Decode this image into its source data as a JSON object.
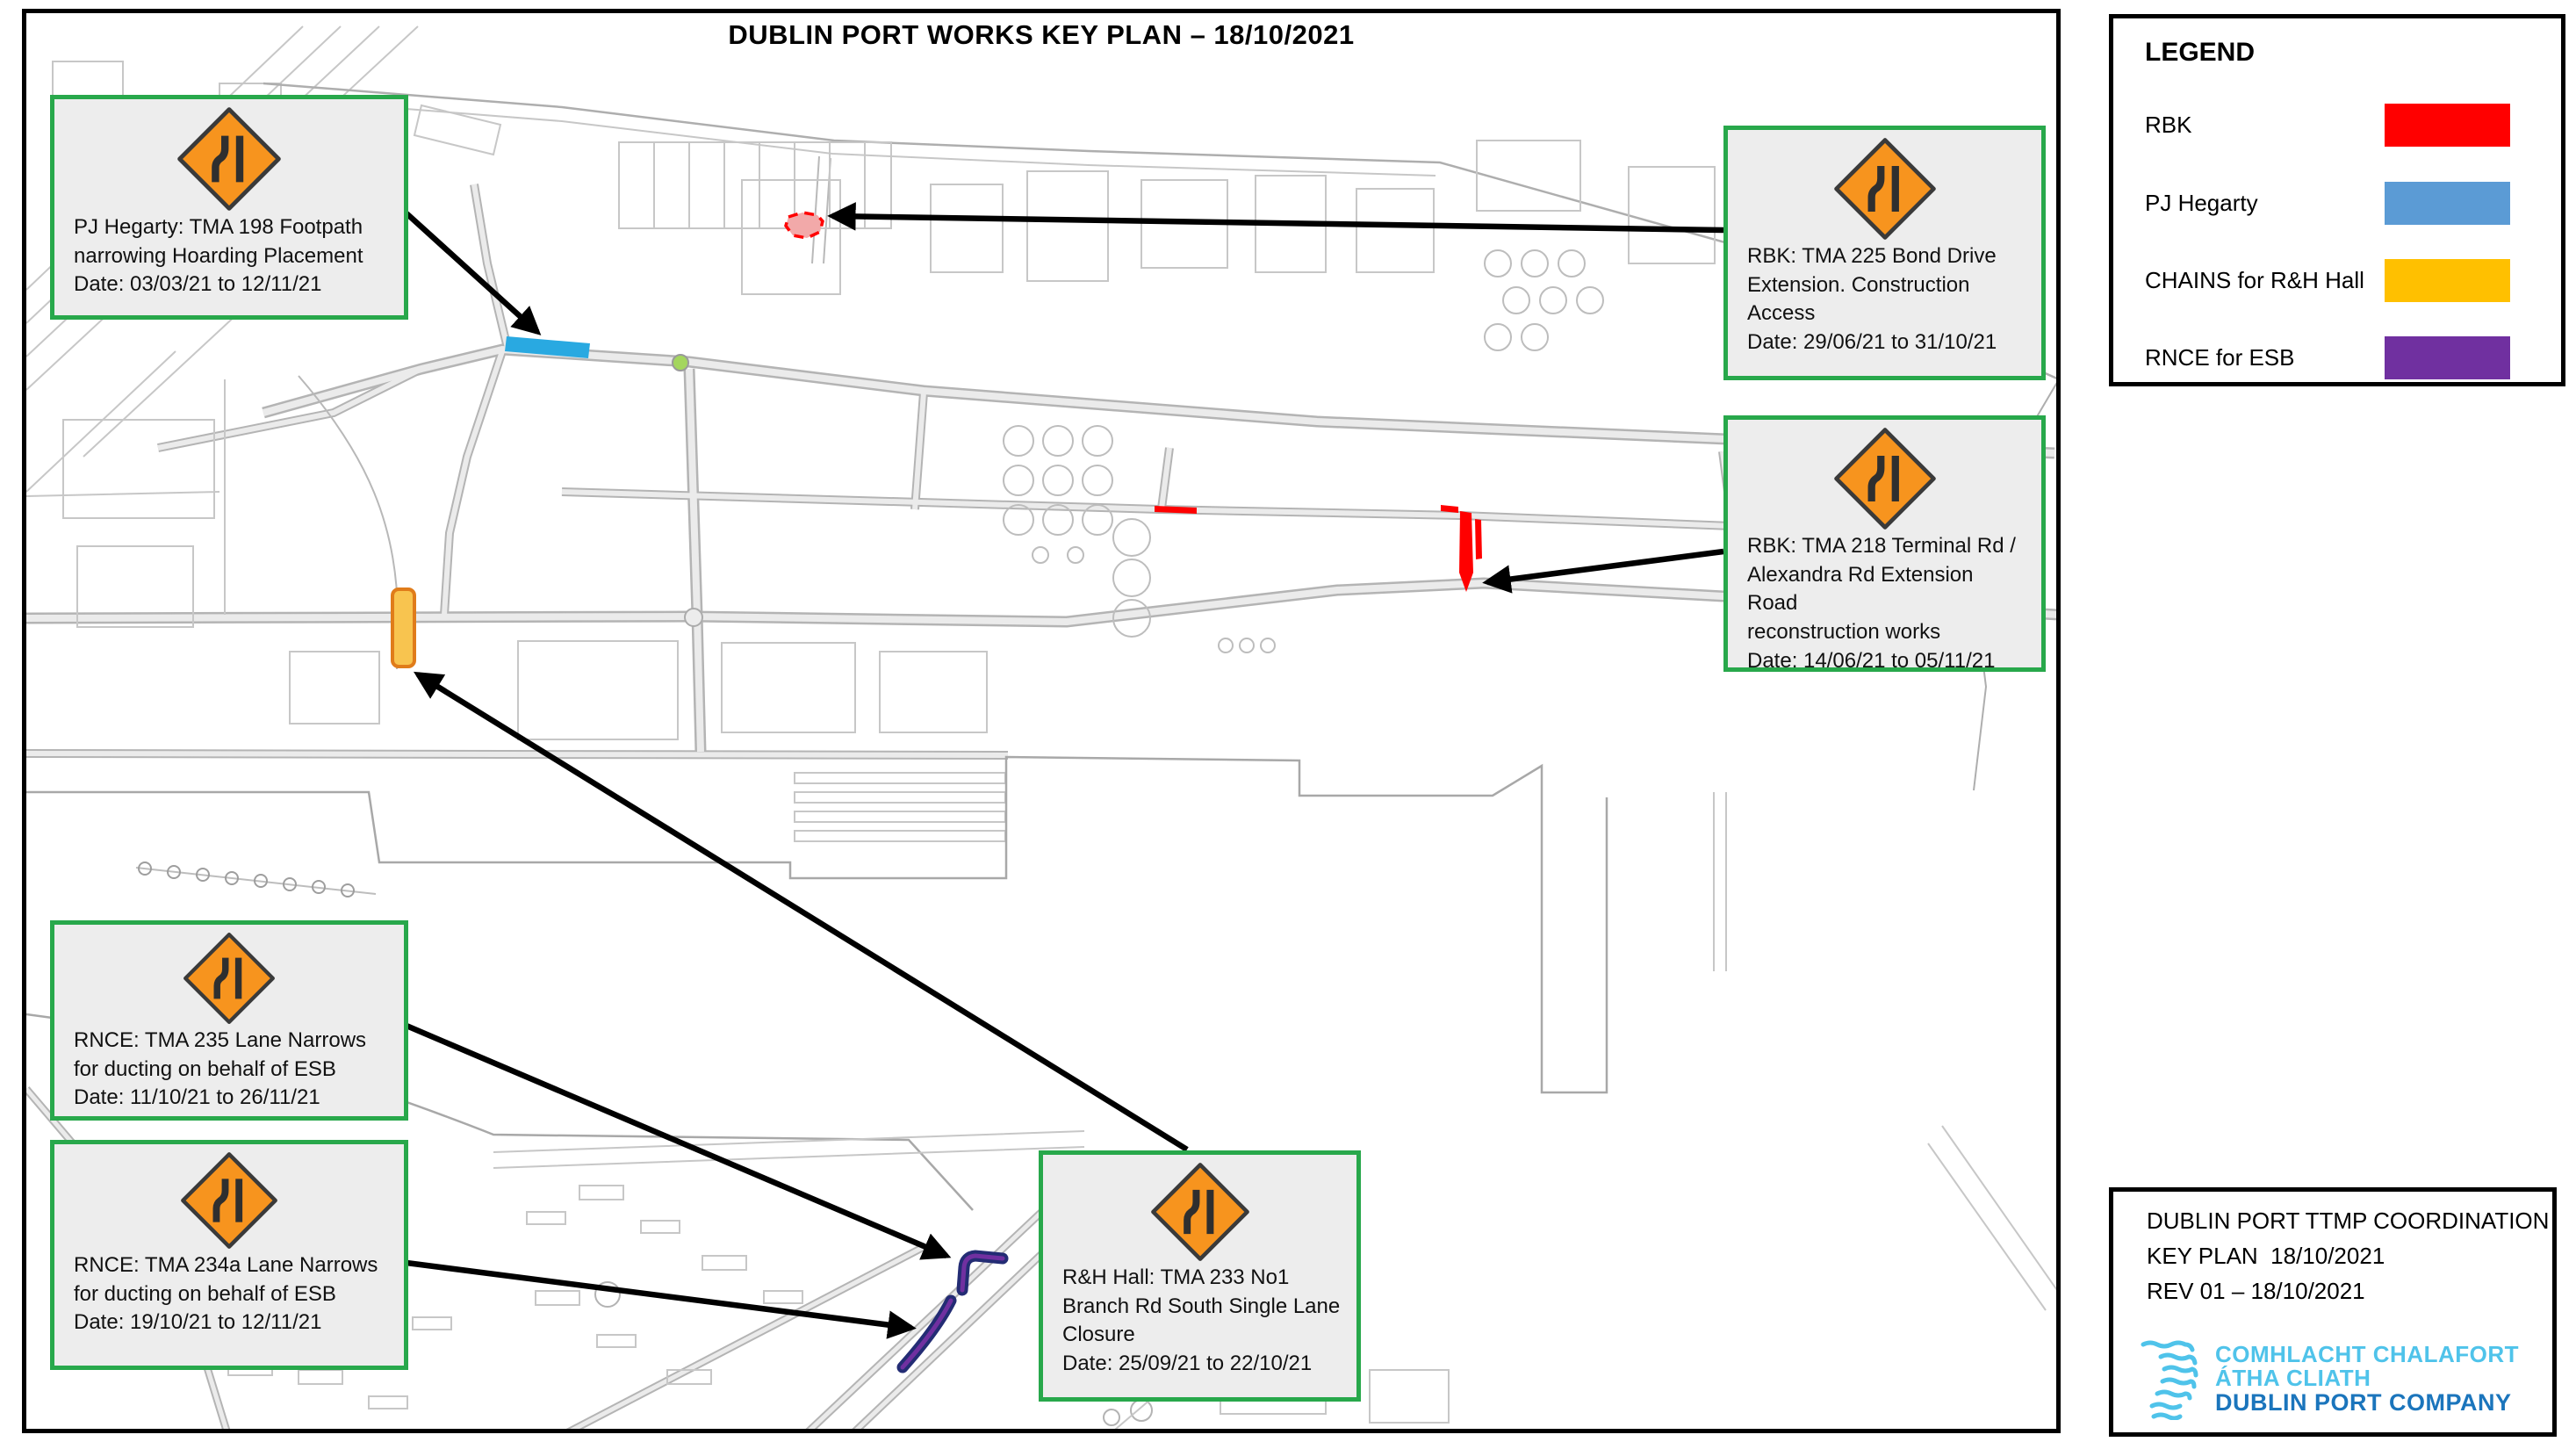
{
  "page": {
    "title": "DUBLIN PORT WORKS KEY PLAN – 18/10/2021"
  },
  "legend": {
    "heading": "LEGEND",
    "items": [
      {
        "label": "RBK",
        "color": "#FF0000"
      },
      {
        "label": "PJ Hegarty",
        "color": "#5B9BD5"
      },
      {
        "label": "CHAINS for R&H Hall",
        "color": "#FFC000"
      },
      {
        "label": "RNCE for ESB",
        "color": "#7030A0"
      }
    ]
  },
  "callouts": {
    "pj_hegarty_198": {
      "lines": [
        "PJ Hegarty: TMA 198 Footpath",
        "narrowing Hoarding Placement",
        "Date: 03/03/21 to 12/11/21"
      ]
    },
    "rbk_225": {
      "lines": [
        "RBK: TMA 225 Bond Drive",
        "Extension. Construction",
        "Access",
        "Date: 29/06/21 to 31/10/21"
      ]
    },
    "rbk_218": {
      "lines": [
        "RBK: TMA 218 Terminal Rd /",
        "Alexandra Rd Extension Road",
        "reconstruction works",
        "Date: 14/06/21 to 05/11/21"
      ]
    },
    "rnce_235": {
      "lines": [
        "RNCE: TMA 235 Lane Narrows",
        "for ducting on behalf of ESB",
        "Date: 11/10/21 to 26/11/21"
      ]
    },
    "rnce_234a": {
      "lines": [
        "RNCE: TMA 234a Lane Narrows",
        "for ducting on behalf of ESB",
        "Date: 19/10/21 to 12/11/21"
      ]
    },
    "rh_hall_233": {
      "lines": [
        "R&H Hall: TMA 233 No1",
        "Branch Rd South Single Lane",
        "Closure",
        "Date: 25/09/21 to 22/10/21"
      ]
    }
  },
  "title_block": {
    "line1": "DUBLIN PORT TTMP COORDINATION",
    "line2": "KEY PLAN  18/10/2021",
    "line3": "REV 01 – 18/10/2021",
    "company_irish_1": "COMHLACHT CHALAFORT",
    "company_irish_2": "ÁTHA CLIATH",
    "company_english": "DUBLIN PORT COMPANY",
    "logo_light_blue": "#4FC3EA",
    "logo_dark_blue": "#1B75BC"
  },
  "map": {
    "sign_color": "#F7941E",
    "marker_colors": {
      "rbk_red": "#FF0000",
      "rbk_area_fill": "#F2A9A9",
      "pj_blue": "#29A9E1",
      "chains_fill": "#F8C44F",
      "chains_border": "#E07C1A",
      "rnce_outline": "#232C74",
      "rnce_core": "#7030A0",
      "roundabout_green": "#A4D65E"
    }
  }
}
